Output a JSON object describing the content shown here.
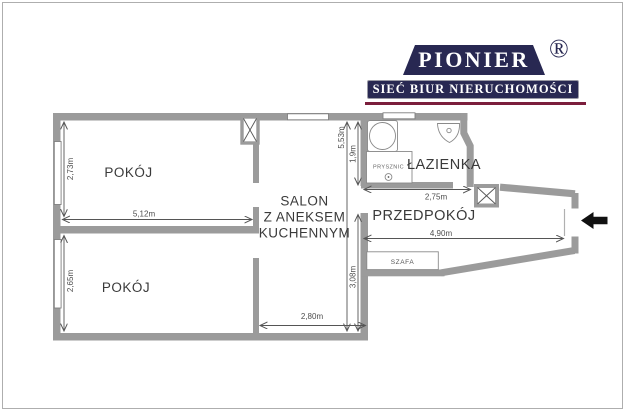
{
  "page": {
    "background": "#ffffff",
    "frame_border_color": "#aeaeae"
  },
  "logo": {
    "brand": "PIONIER",
    "registered": "®",
    "tagline": "SIEĆ BIUR NIERUCHOMOŚCI",
    "navy": "#282852",
    "underline_red": "#7b1e3c",
    "text_color": "#ffffff"
  },
  "floorplan": {
    "wall_color": "#9b9b9b",
    "entrance_arrow_color": "#111111",
    "labels": {
      "room_top": "POKÓJ",
      "room_bottom": "POKÓJ",
      "salon_line1": "SALON",
      "salon_line2": "Z ANEKSEM",
      "salon_line3": "KUCHENNYM",
      "bathroom": "ŁAZIENKA",
      "hallway": "PRZEDPOKÓJ",
      "shower": "PRYSZNIC",
      "wardrobe": "SZAFA"
    },
    "dimensions": {
      "room_top_height": "2,73m",
      "room_top_width": "5,12m",
      "room_bottom_height": "2,65m",
      "salon_full_height": "5,53m",
      "bathroom_height": "1,9m",
      "salon_lower_height": "3,08m",
      "salon_width": "2,80m",
      "bathroom_width": "2,75m",
      "hallway_length": "4,90m"
    }
  }
}
